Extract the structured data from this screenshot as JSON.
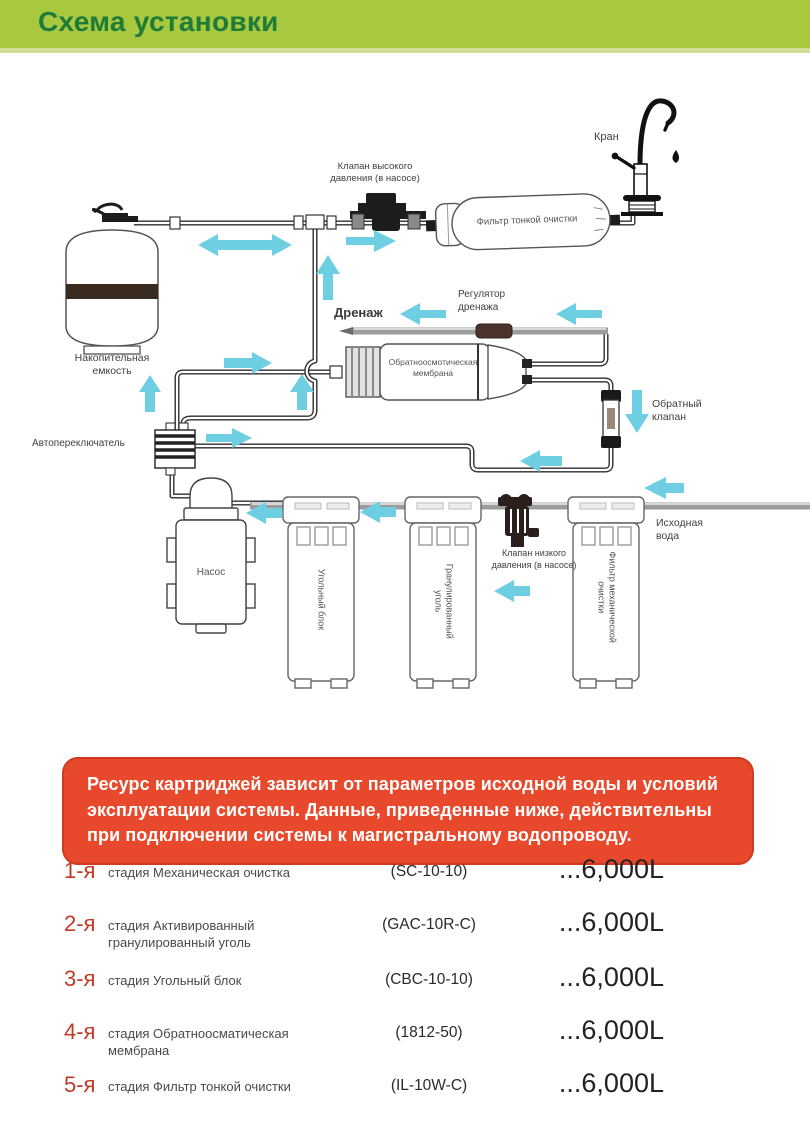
{
  "header": {
    "title": "Схема установки"
  },
  "colors": {
    "header_bg": "#a7c83f",
    "header_text": "#1f7c37",
    "arrow": "#6ecfe3",
    "notice_bg": "#e8492c",
    "stage_number": "#c13927",
    "pipe": "#2e2e2e",
    "drain_pipe": "#9c9c9c",
    "tank_band": "#3a2b21"
  },
  "diagram": {
    "labels": {
      "faucet": "Кран",
      "high_pressure_valve_lines": [
        "Клапан высокого",
        "давления (в насосе)"
      ],
      "fine_filter": "Фильтр тонкой очистки",
      "drain": "Дренаж",
      "drain_regulator_lines": [
        "Регулятор",
        "дренажа"
      ],
      "storage_tank_lines": [
        "Накопительная",
        "емкость"
      ],
      "membrane_lines": [
        "Обратноосмотическая",
        "мембрана"
      ],
      "check_valve_lines": [
        "Обратный",
        "клапан"
      ],
      "auto_switch": "Автопереключатель",
      "pump": "Насос",
      "low_pressure_valve_lines": [
        "Клапан низкого",
        "давления (в насосе)"
      ],
      "feed_water_lines": [
        "Исходная",
        "вода"
      ],
      "filter_carbon_block": "Угольный блок",
      "filter_granular_lines": [
        "Гранулированный",
        "уголь"
      ],
      "filter_mechanical_lines": [
        "Фильтр механической",
        "очистки"
      ]
    }
  },
  "notice": {
    "lines": [
      "Ресурс картриджей зависит от параметров исходной воды и условий",
      "эксплуатации системы. Данные, приведенные ниже, действительны",
      "при подключении системы к магистральному водопроводу."
    ]
  },
  "stages": [
    {
      "number": "1-я",
      "name": "стадия Механическая очистка",
      "code": "(SC-10-10)",
      "resource": "...6,000L"
    },
    {
      "number": "2-я",
      "name": "стадия Активированный гранулированный уголь",
      "code": "(GAC-10R-C)",
      "resource": "...6,000L"
    },
    {
      "number": "3-я",
      "name": "стадия Угольный блок",
      "code": "(CBC-10-10)",
      "resource": "...6,000L"
    },
    {
      "number": "4-я",
      "name": "стадия Обратноосматическая мембрана",
      "code": "(1812-50)",
      "resource": "...6,000L"
    },
    {
      "number": "5-я",
      "name": "стадия Фильтр тонкой очистки",
      "code": "(IL-10W-C)",
      "resource": "...6,000L"
    }
  ]
}
